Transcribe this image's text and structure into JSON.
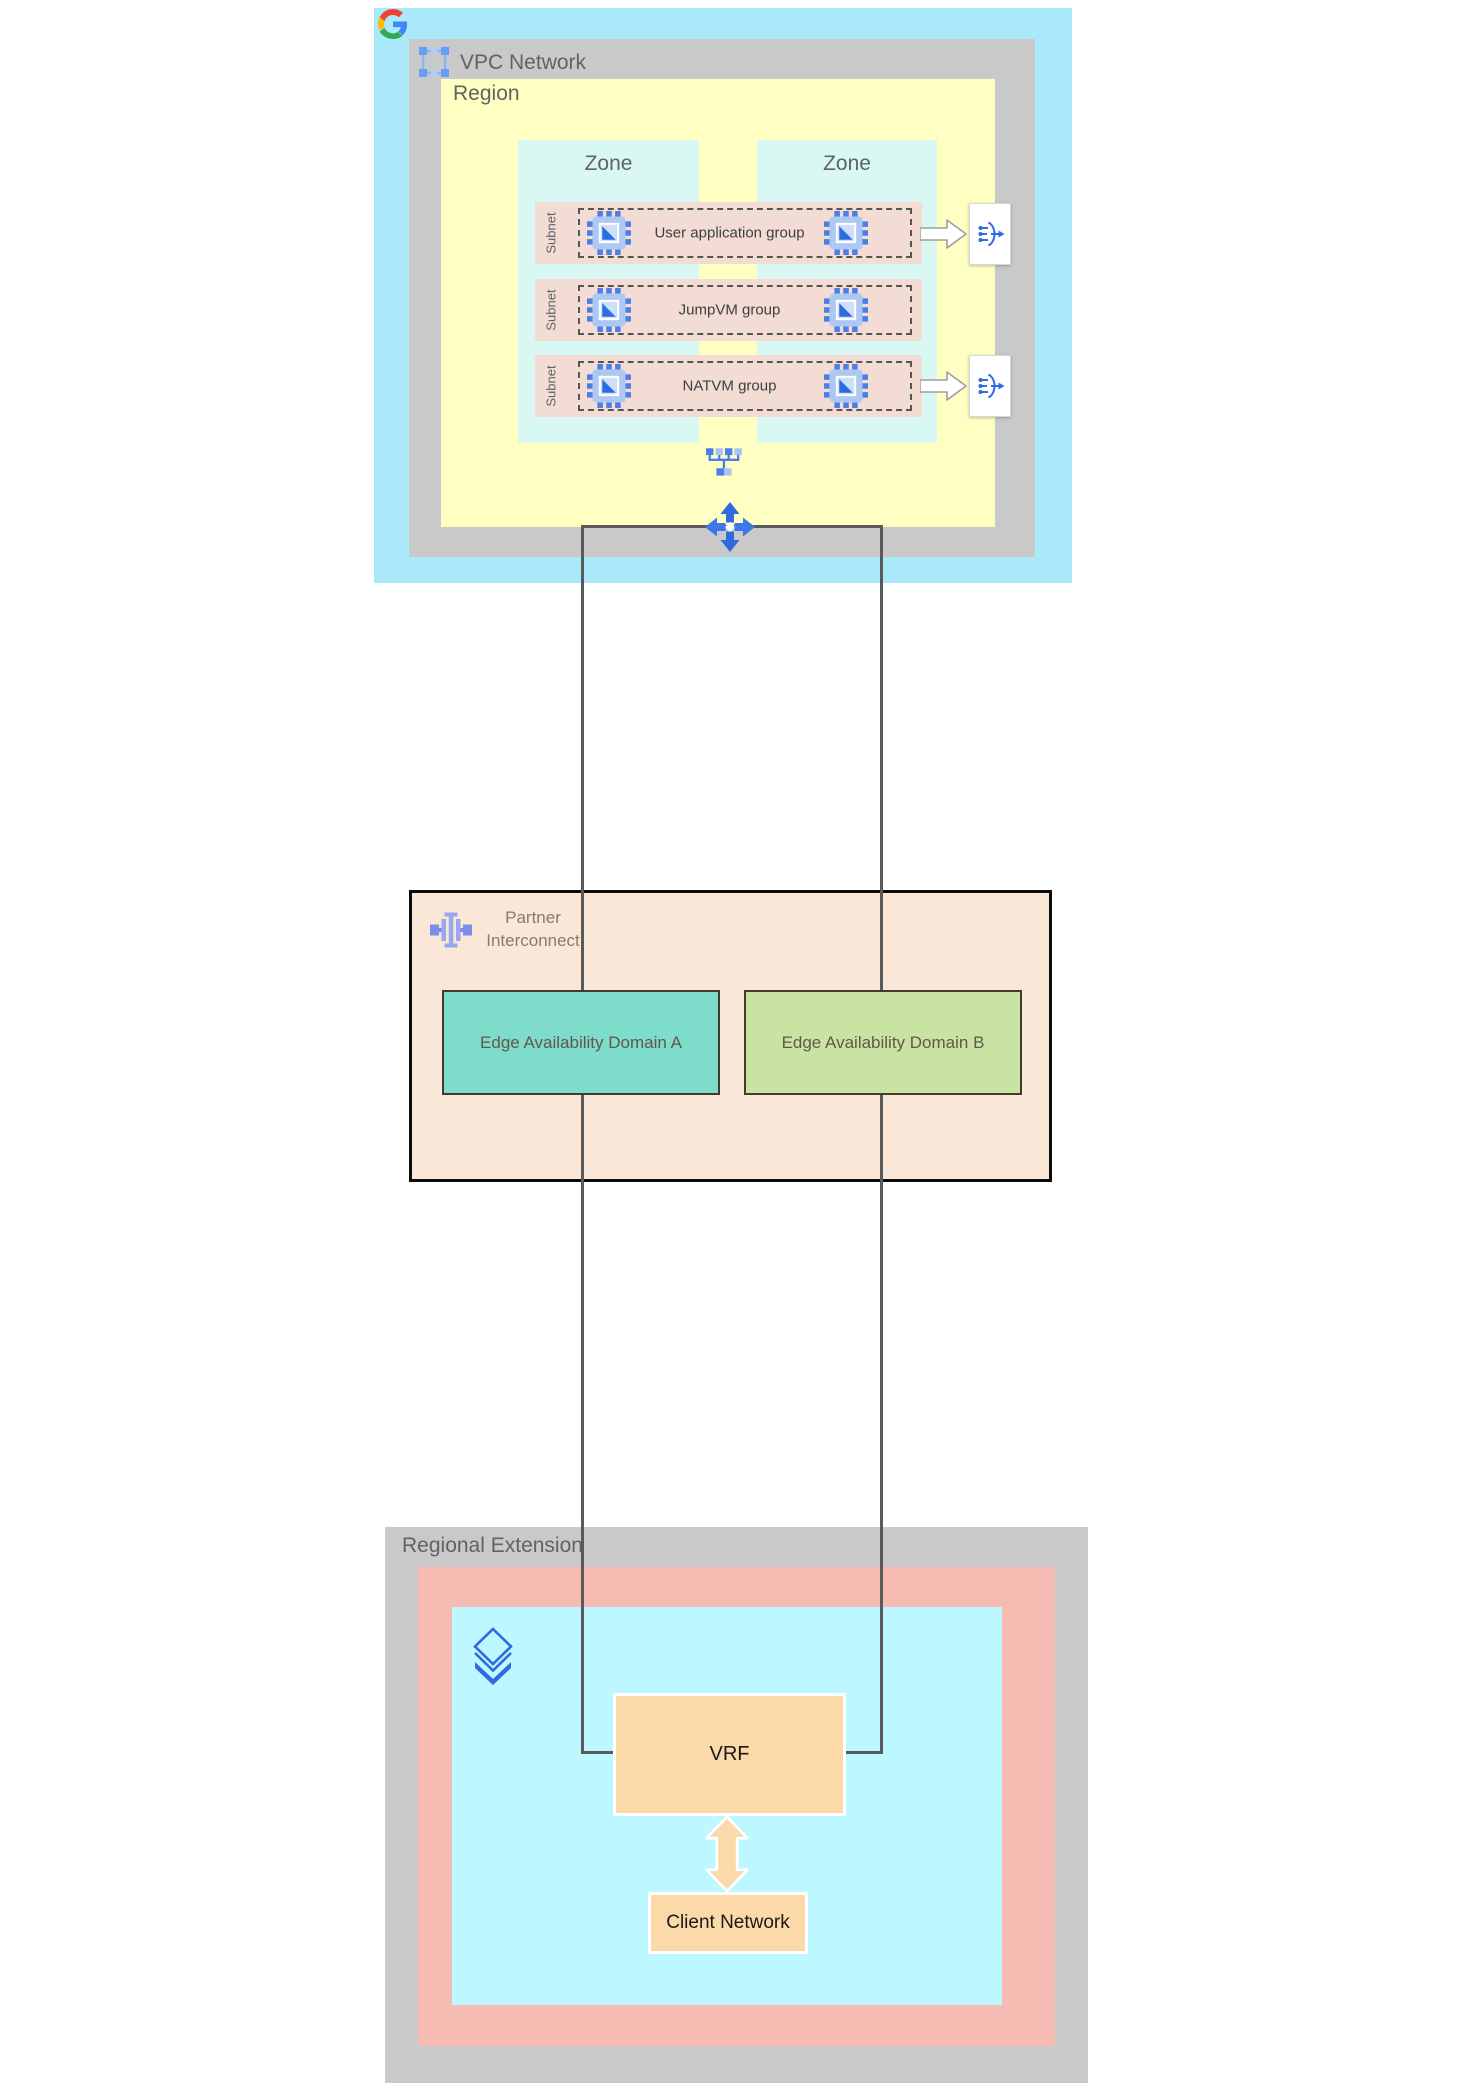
{
  "vpc_network": {
    "title": "VPC Network",
    "region": {
      "title": "Region",
      "zones": [
        {
          "label": "Zone"
        },
        {
          "label": "Zone"
        }
      ],
      "subnets": [
        {
          "side_label": "Subnet",
          "group_label": "User application group"
        },
        {
          "side_label": "Subnet",
          "group_label": "JumpVM group"
        },
        {
          "side_label": "Subnet",
          "group_label": "NATVM group"
        }
      ]
    }
  },
  "partner_interconnect": {
    "title_line1": "Partner",
    "title_line2": "Interconnect",
    "edge_domains": [
      {
        "label": "Edge Availability Domain A"
      },
      {
        "label": "Edge Availability Domain B"
      }
    ]
  },
  "regional_extension": {
    "title": "Regional Extension",
    "vrf": {
      "label": "VRF"
    },
    "client_network": {
      "label": "Client Network"
    }
  },
  "icons": {
    "google_logo": "google-g-logo",
    "vpc": "vpc-icon",
    "vm": "vm-instance-icon",
    "load_balancer": "load-balancer-icon",
    "network_switch": "network-switch-icon",
    "routes": "routes-icon",
    "partner_interconnect": "partner-interconnect-icon",
    "cloud_router": "cloud-router-icon"
  },
  "colors": {
    "vpc_outer_cyan": "#a9e9fa",
    "container_gray": "#c9c9c9",
    "region_yellow": "#feffc0",
    "zone_cyan": "#d9f8f4",
    "subnet_pink": "#f2dcd3",
    "pi_fill": "#fbe7d7",
    "edge_domain_a_teal": "#7edcca",
    "edge_domain_b_green": "#c9e3a2",
    "re_pink": "#f6bcb4",
    "re_cyan": "#bdf7ff",
    "node_orange": "#fbd9a8",
    "connector_line": "#5a5a5a",
    "icon_blue": "#2f6ae0"
  }
}
